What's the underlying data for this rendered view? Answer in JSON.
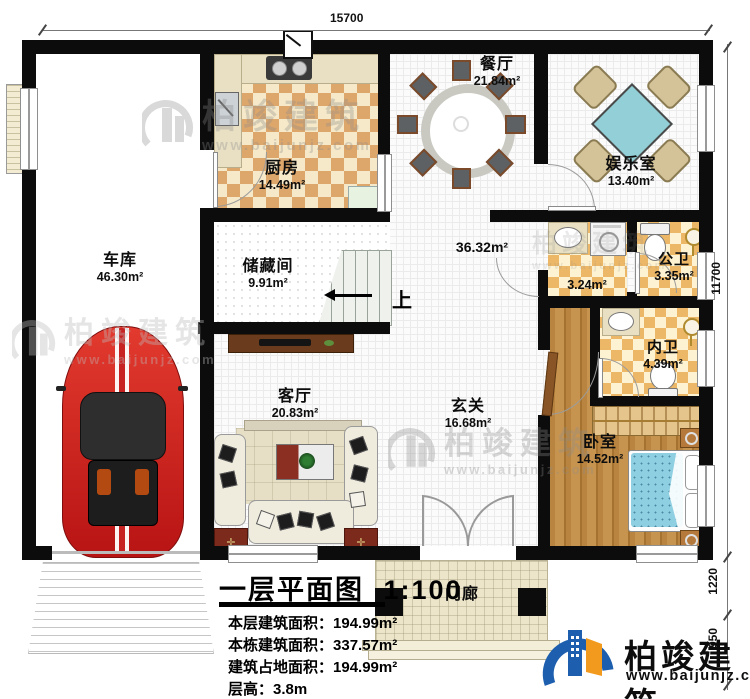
{
  "plan": {
    "title": "一层平面图",
    "scale": "1:100",
    "stats": [
      {
        "label": "本层建筑面积：",
        "value": "194.99m²"
      },
      {
        "label": "本栋建筑面积：",
        "value": "337.57m²"
      },
      {
        "label": "建筑占地面积：",
        "value": "194.99m²"
      },
      {
        "label": "层高：",
        "value": "3.8m"
      }
    ]
  },
  "rooms": {
    "garage": {
      "name": "车库",
      "area": "46.30m²"
    },
    "kitchen": {
      "name": "厨房",
      "area": "14.49m²"
    },
    "dining": {
      "name": "餐厅",
      "area": "21.84m²"
    },
    "entertainment": {
      "name": "娱乐室",
      "area": "13.40m²"
    },
    "storage": {
      "name": "储藏间",
      "area": "9.91m²"
    },
    "hall": {
      "name": "",
      "area": "36.32m²"
    },
    "corridor": {
      "name": "",
      "area": "3.24m²"
    },
    "public_bath": {
      "name": "公卫",
      "area": "3.35m²"
    },
    "private_bath": {
      "name": "内卫",
      "area": "4.39m²"
    },
    "foyer": {
      "name": "玄关",
      "area": "16.68m²"
    },
    "living": {
      "name": "客厅",
      "area": "20.83m²"
    },
    "bedroom": {
      "name": "卧室",
      "area": "14.52m²"
    },
    "porch": {
      "name": "门廊",
      "area": ""
    }
  },
  "stairs": {
    "up_label": "上"
  },
  "dimensions": {
    "top": "15700",
    "right_main": "11700",
    "right_mid": "1220",
    "right_bottom": "950"
  },
  "brand": {
    "name": "柏竣建筑",
    "url": "www.baijunjz.com"
  },
  "colors": {
    "wall": "#0c0c0c",
    "kitchen_tile": "#dda76b",
    "bath_tile": "#ecb867",
    "wood": "#b8843f",
    "logo_blue": "#1d5fae",
    "logo_orange": "#f29a1d",
    "car_red": "#cf1d1d",
    "table_teal": "#93cfd6"
  }
}
